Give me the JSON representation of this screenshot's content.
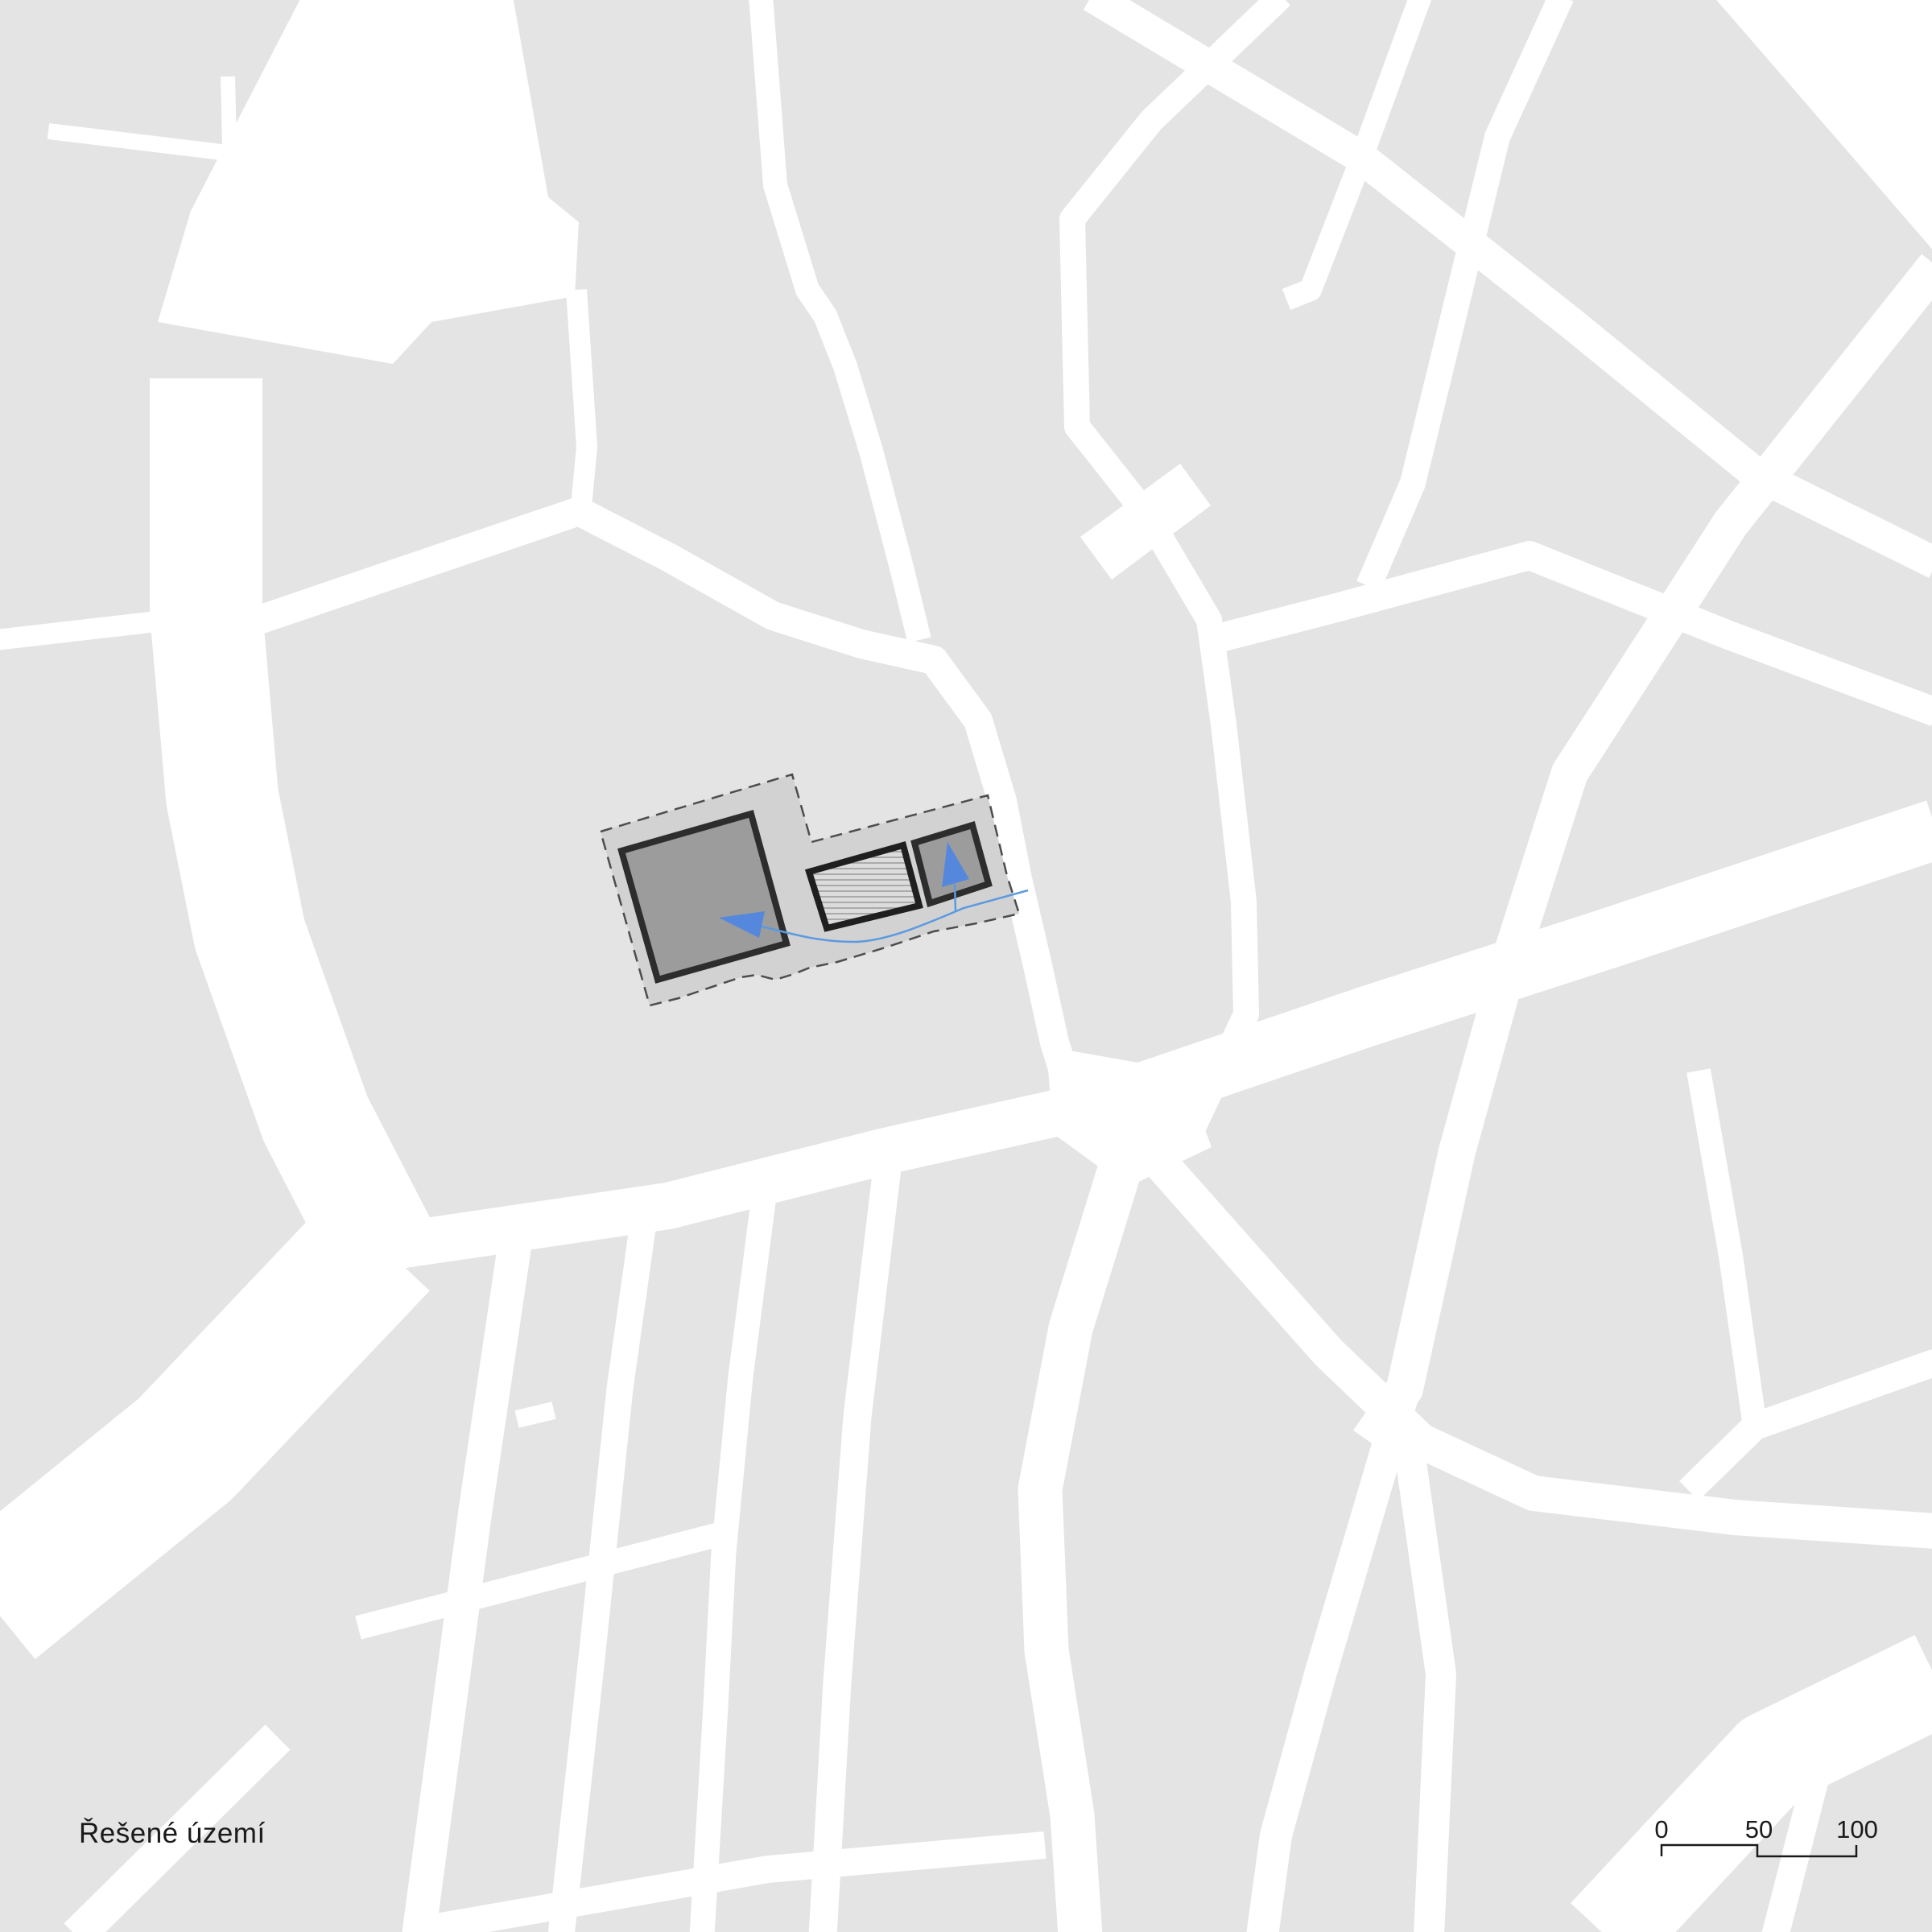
{
  "map": {
    "kind": "urban figure-ground site plan",
    "title": "Řešené území (site location plan)",
    "blocks_color": "#e4e4e4",
    "streets_color": "#ffffff"
  },
  "legend": {
    "label": "Řešené území"
  },
  "scalebar": {
    "t0": "0",
    "t50": "50",
    "t100": "100",
    "ticks": [
      0,
      50,
      100
    ]
  },
  "site": {
    "name": "Řešené území (solved territory)",
    "boundary_style": "dashed",
    "elements": [
      {
        "name": "main-building",
        "shape": "large rotated square",
        "fill": "dark-gray"
      },
      {
        "name": "hatched-courtyard",
        "shape": "rotated rectangle",
        "fill": "horizontal hatch"
      },
      {
        "name": "secondary-building",
        "shape": "small rotated square",
        "fill": "dark-gray"
      },
      {
        "name": "entry-arrow-west",
        "shape": "blue triangle pointing left"
      },
      {
        "name": "entry-arrow-north",
        "shape": "blue triangle pointing up"
      },
      {
        "name": "flow-line",
        "shape": "thin blue polyline"
      }
    ]
  },
  "colors": {
    "street": "#ffffff",
    "block_gray": "#e4e4e4",
    "site_fill": "#d2d2d2",
    "site_border": "#4d4d4d",
    "building_fill": "#9c9c9c",
    "building_stroke": "#2d2d2d",
    "hatch_bg": "#dcdcdc",
    "hatch_line": "#9e9e9e",
    "accent_blue": "#5588dd",
    "line_blue": "#5b9ae0",
    "text": "#1a1a1a"
  }
}
